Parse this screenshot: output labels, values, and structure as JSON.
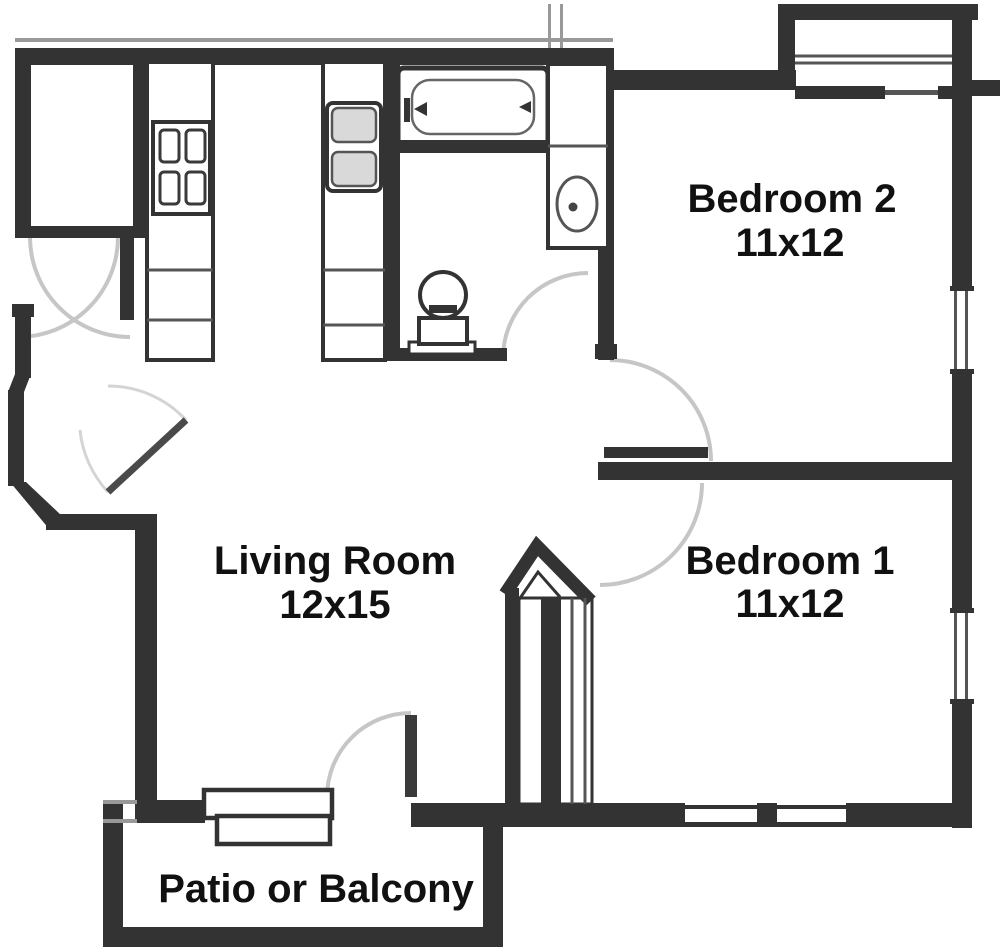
{
  "floor_plan": {
    "type": "apartment-floor-plan",
    "rooms": {
      "bedroom2": {
        "name": "Bedroom 2",
        "dims": "11x12"
      },
      "bedroom1": {
        "name": "Bedroom 1",
        "dims": "11x12"
      },
      "living_room": {
        "name": "Living Room",
        "dims": "12x15"
      },
      "patio": {
        "name": "Patio or Balcony"
      }
    },
    "colors": {
      "wall": "#333333",
      "background": "#ffffff",
      "door_arc": "#c6c6c6",
      "fixture_fill": "#d9d9d9",
      "label_text": "#111111"
    }
  }
}
